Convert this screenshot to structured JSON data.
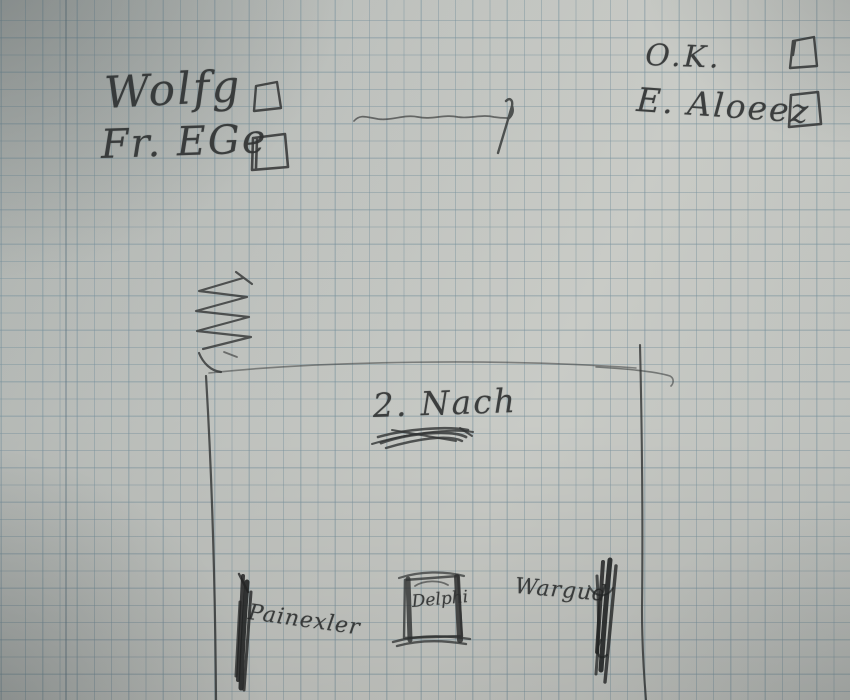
{
  "scene": {
    "type": "photograph of a handwritten pencil sketch on squared graph paper",
    "paper_color": "#c3c6c2",
    "grid_color": "#8fa2ab",
    "pencil_color": "#3a3c3c",
    "grid_spacing_px": 17
  },
  "checklist_left": {
    "line1": {
      "label": "Wolfg",
      "checkbox_state": "empty"
    },
    "line2": {
      "label": "Fr. EGe",
      "checkbox_state": "empty"
    }
  },
  "checklist_right": {
    "line1": {
      "label": "O.K.",
      "checkbox_state": "empty"
    },
    "line2": {
      "label": "E. Aloeez",
      "checkbox_state": "empty"
    }
  },
  "sketch": {
    "arrow_note": "wavy horizontal pencil line ending in upward arrow stroke",
    "zigzag_note": "zigzag pencil scribble above plan",
    "plan_label": "2. Nach",
    "plan_label_note": "word below scribbled out",
    "bottom_left_label": "Painexler",
    "center_box_label": "Delphi",
    "bottom_right_label": "Wargud"
  }
}
